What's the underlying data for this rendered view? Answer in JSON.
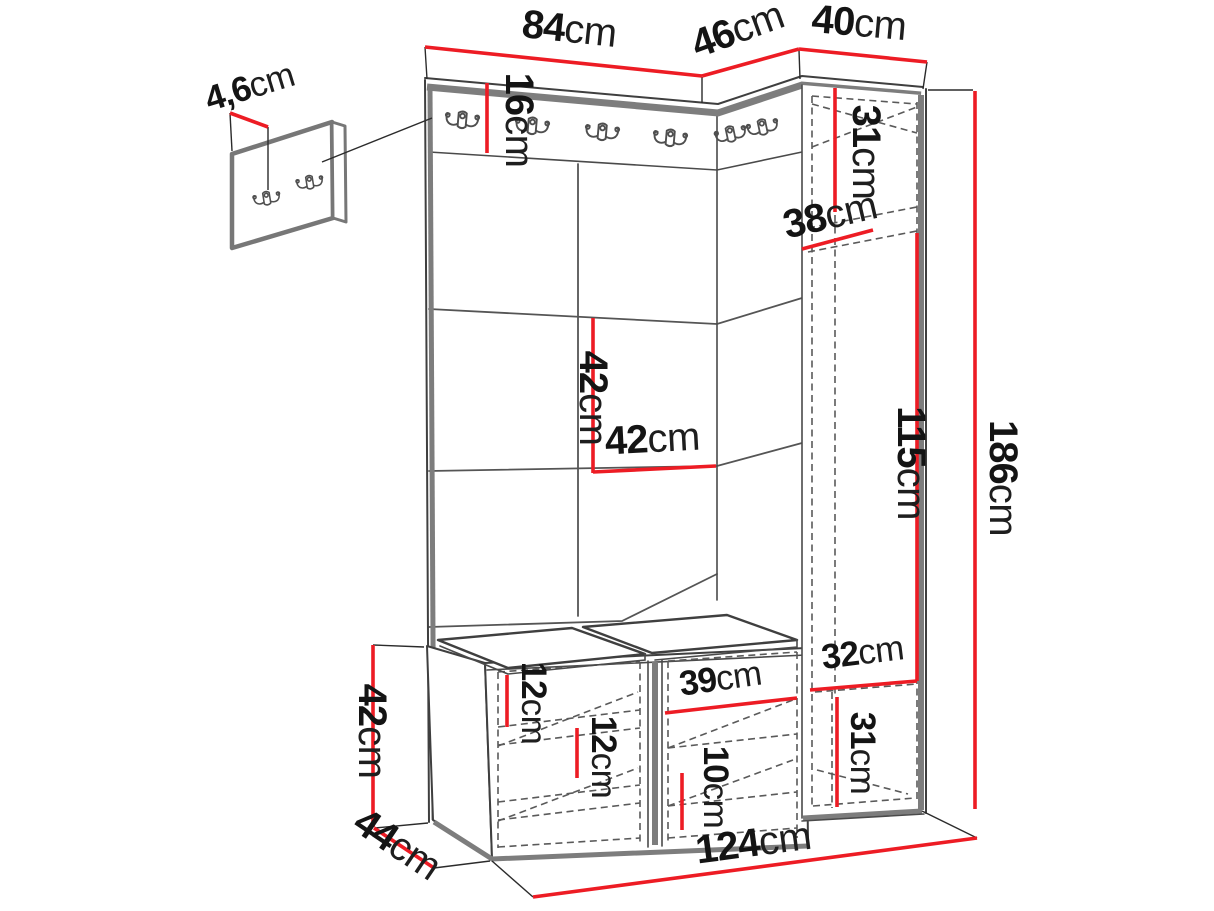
{
  "diagram": {
    "type": "furniture-dimension-drawing",
    "subject": "hallway wardrobe set with coat hooks, panels, bench and tall cabinet",
    "default_unit": "cm",
    "colors": {
      "dimension_line": "#ed1c24",
      "outline": "#3f3f3f",
      "soft_edge": "#7d7d7d",
      "hidden_line": "#5a5a5a",
      "label_text": "#141414",
      "background": "#ffffff"
    },
    "icons": {
      "coat_hook": "double-coat-hook-icon",
      "wall_panel_hook": "double-coat-hook-icon"
    },
    "labels": {
      "d84": {
        "value": "84",
        "unit": "cm",
        "label": "84cm"
      },
      "d46": {
        "value": "46",
        "unit": "cm",
        "label": "46cm"
      },
      "d40": {
        "value": "40",
        "unit": "cm",
        "label": "40cm"
      },
      "d4_6": {
        "value": "4,6",
        "unit": "cm",
        "label": "4,6cm"
      },
      "d16": {
        "value": "16",
        "unit": "cm",
        "label": "16cm"
      },
      "d31_top": {
        "value": "31",
        "unit": "cm",
        "label": "31cm"
      },
      "d38": {
        "value": "38",
        "unit": "cm",
        "label": "38cm"
      },
      "d42_v": {
        "value": "42",
        "unit": "cm",
        "label": "42cm"
      },
      "d42_h": {
        "value": "42",
        "unit": "cm",
        "label": "42cm"
      },
      "d115": {
        "value": "115",
        "unit": "cm",
        "label": "115cm"
      },
      "d186": {
        "value": "186",
        "unit": "cm",
        "label": "186cm"
      },
      "d32": {
        "value": "32",
        "unit": "cm",
        "label": "32cm"
      },
      "d31_bot": {
        "value": "31",
        "unit": "cm",
        "label": "31cm"
      },
      "d12_a": {
        "value": "12",
        "unit": "cm",
        "label": "12cm"
      },
      "d12_b": {
        "value": "12",
        "unit": "cm",
        "label": "12cm"
      },
      "d39": {
        "value": "39",
        "unit": "cm",
        "label": "39cm"
      },
      "d10": {
        "value": "10",
        "unit": "cm",
        "label": "10cm"
      },
      "d42_bench": {
        "value": "42",
        "unit": "cm",
        "label": "42cm"
      },
      "d44": {
        "value": "44",
        "unit": "cm",
        "label": "44cm"
      },
      "d124": {
        "value": "124",
        "unit": "cm",
        "label": "124cm"
      }
    }
  }
}
